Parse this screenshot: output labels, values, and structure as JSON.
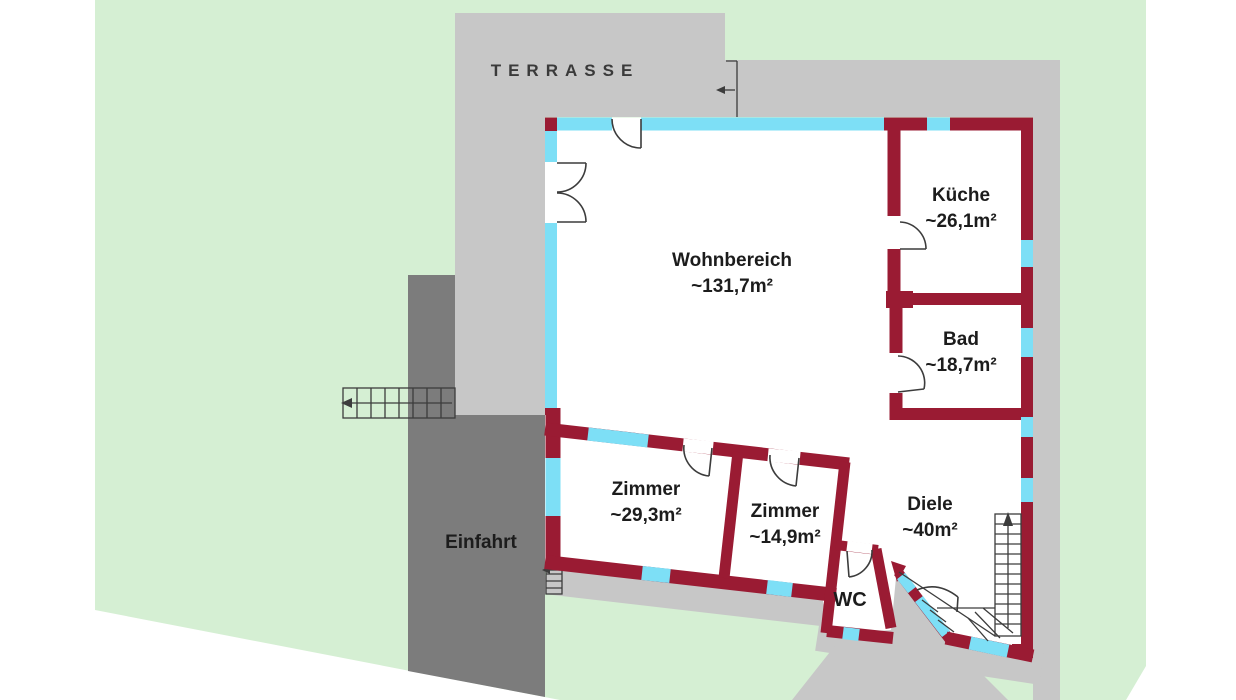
{
  "site": {
    "terrace_label": "TERRASSE",
    "driveway_label": "Einfahrt"
  },
  "rooms": [
    {
      "id": "wohnbereich",
      "name": "Wohnbereich",
      "area": "~131,7m²"
    },
    {
      "id": "kueche",
      "name": "Küche",
      "area": "~26,1m²"
    },
    {
      "id": "bad",
      "name": "Bad",
      "area": "~18,7m²"
    },
    {
      "id": "zimmer-1",
      "name": "Zimmer",
      "area": "~29,3m²"
    },
    {
      "id": "zimmer-2",
      "name": "Zimmer",
      "area": "~14,9m²"
    },
    {
      "id": "diele",
      "name": "Diele",
      "area": "~40m²"
    },
    {
      "id": "wc",
      "name": "WC",
      "area": ""
    }
  ],
  "colors": {
    "green": "#d5efd3",
    "paving": "#c7c7c7",
    "driveway": "#7c7c7c",
    "wall": "#9a1b33",
    "window": "#7ddff6",
    "floor": "#ffffff",
    "line": "#3c3c3c",
    "text": "#1c1c1c",
    "terracetext": "#3a3a3a"
  }
}
